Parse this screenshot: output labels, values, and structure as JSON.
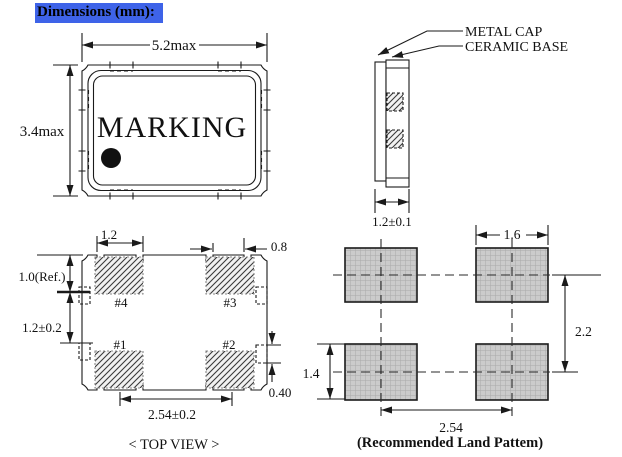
{
  "header": {
    "title": "Dimensions (mm):",
    "highlight_color": "#3E63E8"
  },
  "package_top_view": {
    "marking": "MARKING",
    "width_dim": "5.2max",
    "height_dim": "3.4max"
  },
  "side_view": {
    "cap_label": "METAL CAP",
    "base_label": "CERAMIC BASE",
    "thickness_dim": "1.2±0.1"
  },
  "bottom_view": {
    "pad_width_dim": "1.2",
    "notch_dim": "0.8",
    "ref_dim": "1.0(Ref.)",
    "vertical_pitch_dim": "1.2±0.2",
    "horizontal_pitch_dim": "2.54±0.2",
    "castellation_dim": "0.40",
    "pads": [
      "#1",
      "#2",
      "#3",
      "#4"
    ],
    "caption": "< TOP VIEW >"
  },
  "land_pattern": {
    "pad_width_dim": "1.6",
    "vertical_pitch_dim": "2.2",
    "pad_height_dim": "1.4",
    "horizontal_pitch_dim": "2.54",
    "caption": "(Recommended Land Pattem)"
  },
  "colors": {
    "line": "#1a1a1a",
    "land_pad_fill": "#cbcbcb",
    "header_bg": "#3E63E8"
  }
}
